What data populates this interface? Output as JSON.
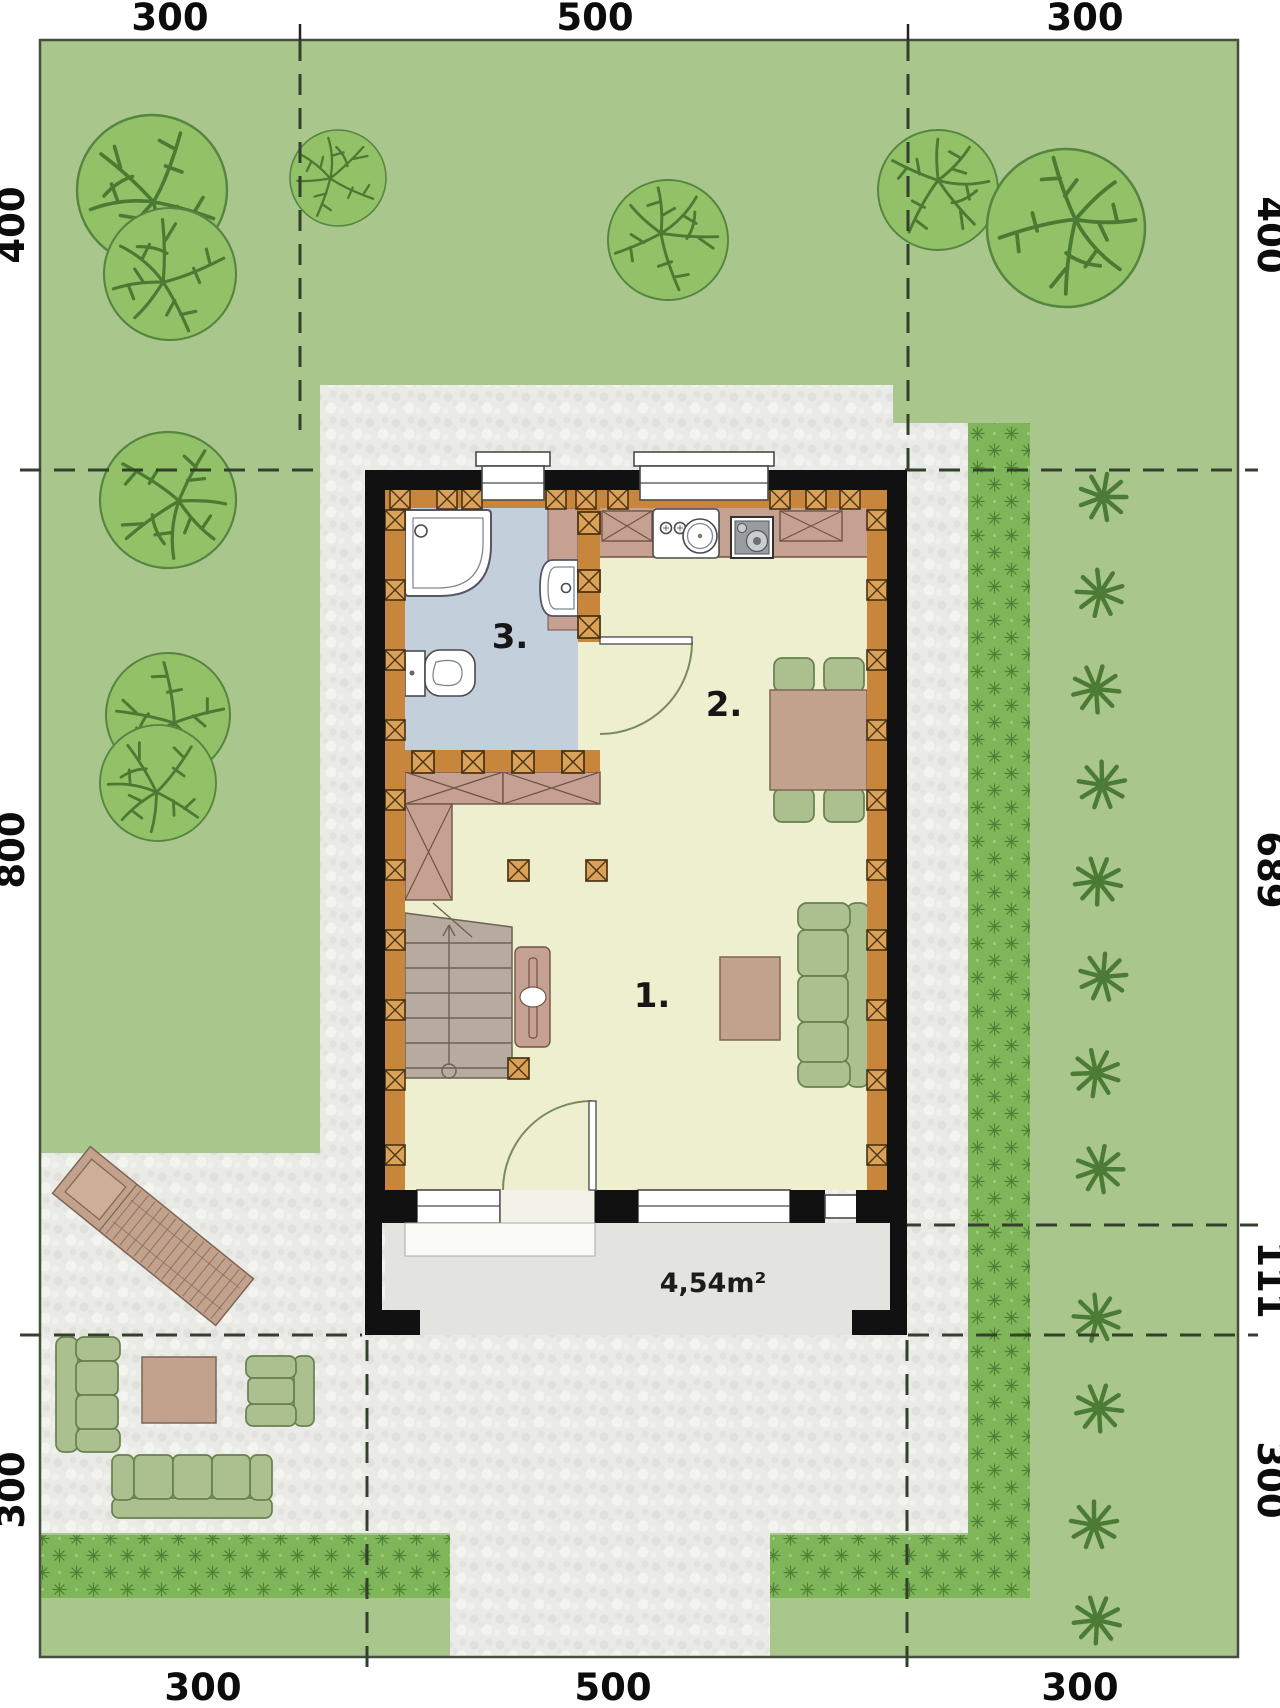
{
  "plan": {
    "dimensions": {
      "top": [
        "300",
        "500",
        "300"
      ],
      "bottom": [
        "300",
        "500",
        "300"
      ],
      "left": [
        "400",
        "800",
        "300"
      ],
      "right": [
        "400",
        "689",
        "111",
        "300"
      ]
    },
    "rooms": [
      {
        "label": "1."
      },
      {
        "label": "2."
      },
      {
        "label": "3."
      }
    ],
    "terrace": {
      "area_label": "4,54m²"
    },
    "colors": {
      "lawn": "#a9c68c",
      "hedge": "#7fb65a",
      "paving": "#eaebe7",
      "porch": "#e3e4e0",
      "wall": "#111111",
      "wood": "#c8863d",
      "floor_main": "#edefce",
      "floor_bath": "#c4cfdc",
      "cabinet": "#c6a191",
      "stairs": "#b7aa9e",
      "furn_green": "#abbf8f",
      "furn_tan": "#c3a28d",
      "tree": "#92c168",
      "shrub": "#4c7b36",
      "dash": "#33402b",
      "text": "#0c0c0c"
    }
  }
}
